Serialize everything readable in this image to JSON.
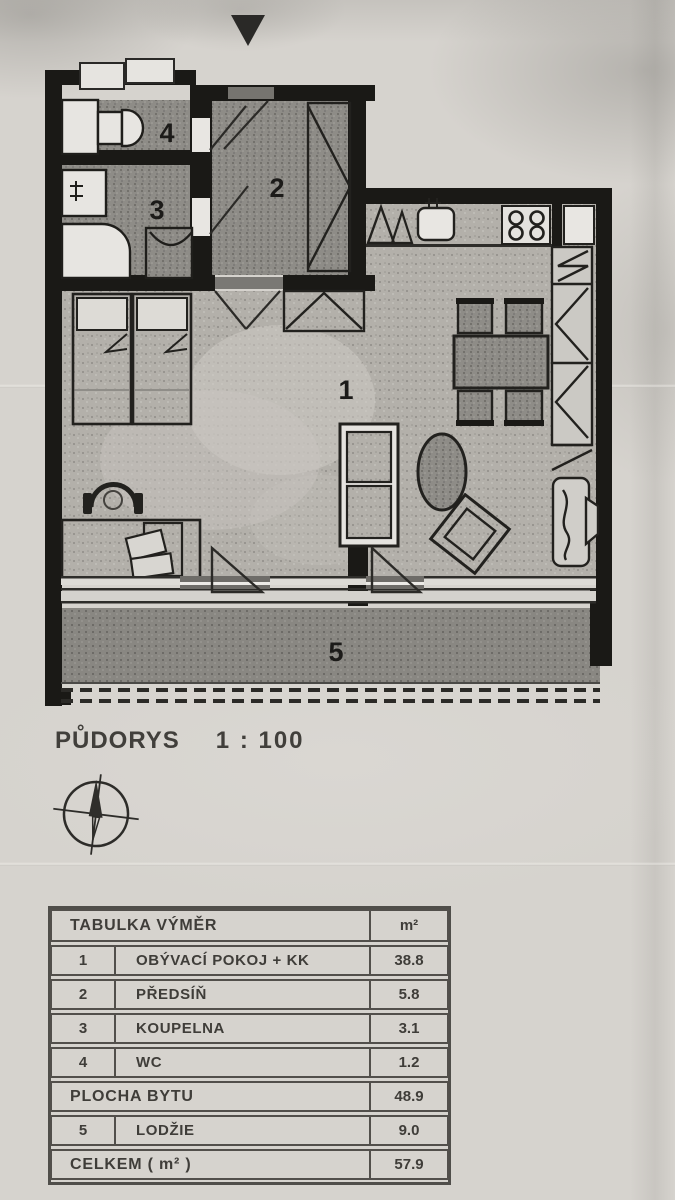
{
  "plan": {
    "title": "PŮDORYS",
    "scale": "1 : 100",
    "rooms": [
      {
        "number": "1",
        "name": "OBÝVACÍ POKOJ + KK"
      },
      {
        "number": "2",
        "name": "PŘEDSÍŇ"
      },
      {
        "number": "3",
        "name": "KOUPELNA"
      },
      {
        "number": "4",
        "name": "WC"
      },
      {
        "number": "5",
        "name": "LODŽIE"
      }
    ],
    "icons": {
      "entrance_marker": "filled-down-triangle",
      "compass": "compass-rose",
      "furniture": [
        "toilet",
        "washbasin",
        "shower",
        "washing-machine",
        "wardrobe",
        "fridge",
        "kitchen-sink",
        "stove-4-burners",
        "dining-table",
        "chairs",
        "beds",
        "desk",
        "desk-chair",
        "sofa",
        "oval-table",
        "armchair",
        "built-in-closet",
        "loggia-railing"
      ]
    }
  },
  "table": {
    "title": "TABULKA VÝMĚR",
    "unit_header": "m²",
    "rows": [
      {
        "num": "1",
        "label": "OBÝVACÍ POKOJ + KK",
        "value": "38.8"
      },
      {
        "num": "2",
        "label": "PŘEDSÍŇ",
        "value": "5.8"
      },
      {
        "num": "3",
        "label": "KOUPELNA",
        "value": "3.1"
      },
      {
        "num": "4",
        "label": "WC",
        "value": "1.2"
      }
    ],
    "subtotal": {
      "label": "PLOCHA BYTU",
      "value": "48.9"
    },
    "loggia_row": {
      "num": "5",
      "label": "LODŽIE",
      "value": "9.0"
    },
    "total": {
      "label": "CELKEM  ( m² )",
      "value": "57.9"
    }
  },
  "colors": {
    "paper": "#d6d3ce",
    "wall_ink": "#1a1916",
    "text_ink": "#3f3d39",
    "room_fill_dark": "#8e8c87",
    "room_fill_light": "#b3b0aa",
    "loggia_fill": "#898782"
  }
}
